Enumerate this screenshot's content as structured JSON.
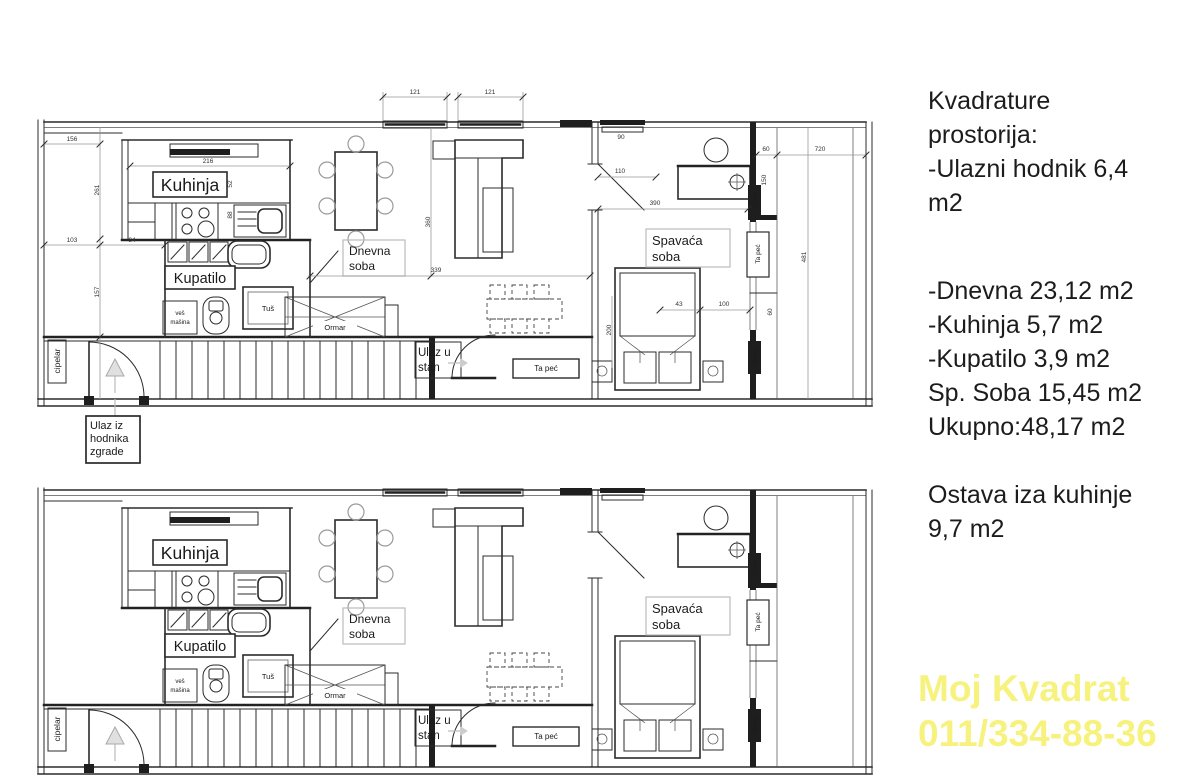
{
  "info_panel": {
    "para1": [
      "Kvadrature",
      "prostorija:",
      "-Ulazni hodnik 6,4",
      "m2"
    ],
    "para2": [
      "-Dnevna 23,12 m2",
      "-Kuhinja 5,7 m2",
      "-Kupatilo 3,9 m2",
      "Sp. Soba 15,45 m2",
      "Ukupno:48,17 m2"
    ],
    "para3": [
      "Ostava iza kuhinje",
      "9,7 m2"
    ]
  },
  "watermark": {
    "line1": "Moj Kvadrat",
    "line2": "011/334-88-36",
    "color": "#f6f27d"
  },
  "plan": {
    "rooms": {
      "kitchen": "Kuhinja",
      "bathroom": "Kupatilo",
      "living1": "Dnevna",
      "living2": "soba",
      "bedroom1": "Spavaća",
      "bedroom2": "soba"
    },
    "labels": {
      "entrance1": "Ulaz u",
      "entrance2": "stan",
      "building_entrance1": "Ulaz iz",
      "building_entrance2": "hodnika",
      "building_entrance3": "zgrade",
      "shoe_rack": "cipelar",
      "washer1": "veš",
      "washer2": "mašina",
      "shower": "Tuš",
      "wardrobe_x": "Ormar",
      "wardrobe_closet": "Orman",
      "tile_stove": "Ta peć"
    },
    "dimensions": {
      "window_left": "121",
      "window_right": "121",
      "hall_width": "156",
      "hall_height": "261",
      "entry_w1": "103",
      "entry_w2": "84",
      "entry_height": "157",
      "kitchen_width": "216",
      "k_52": "52",
      "k_88": "88",
      "living_height": "360",
      "living_width": "339",
      "bedroom_door": "390",
      "bed_win": "110",
      "win_90": "90",
      "right_720": "720",
      "right_60": "60",
      "right_150": "150",
      "right_481": "481",
      "closet_43": "43",
      "closet_100": "100",
      "closet_60": "60",
      "bed_200": "200"
    }
  }
}
